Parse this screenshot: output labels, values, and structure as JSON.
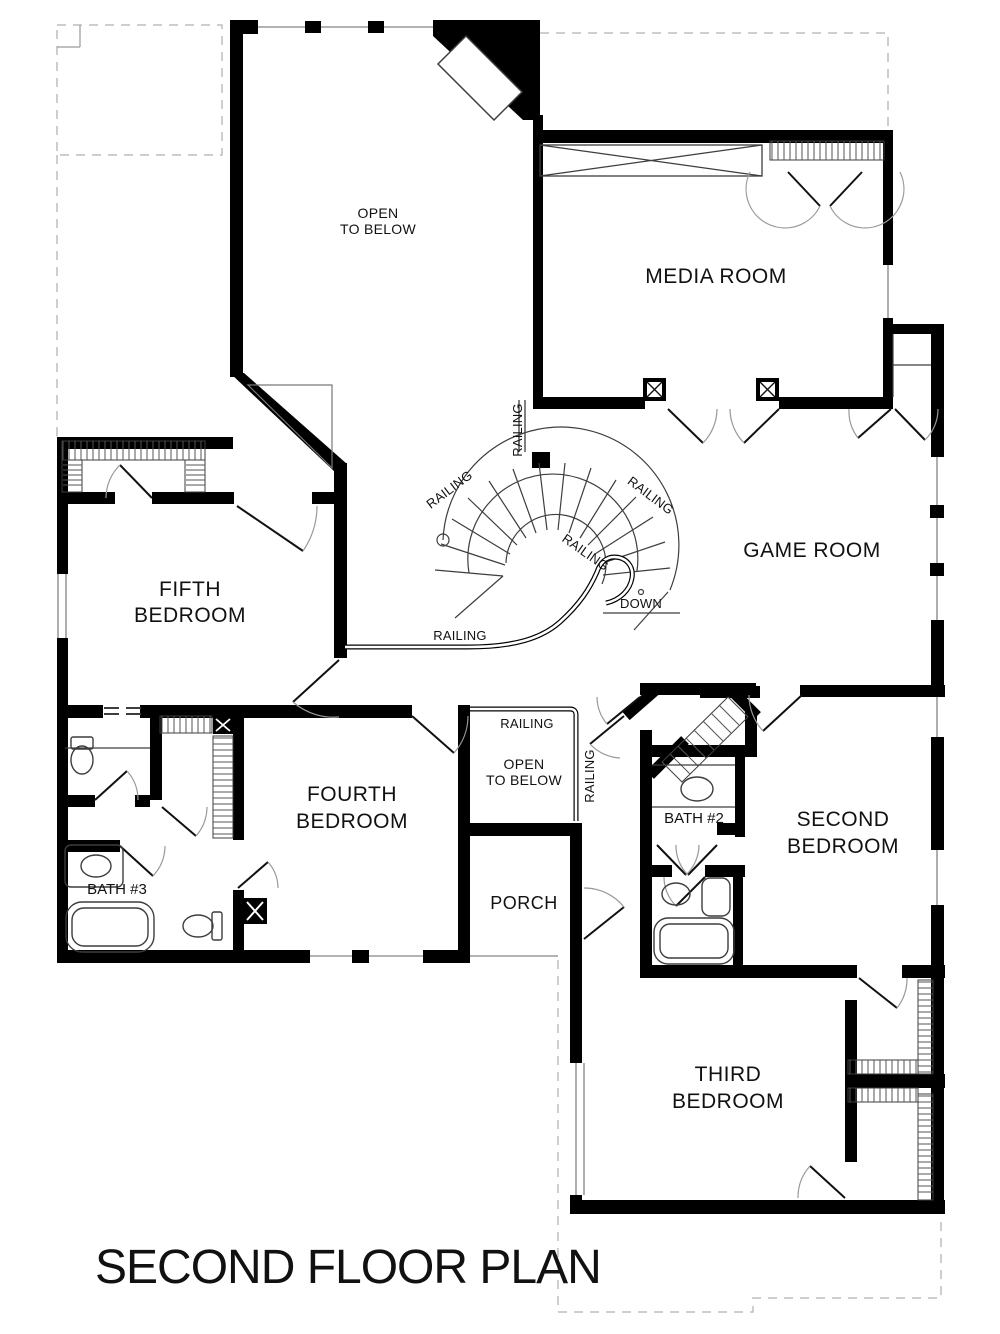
{
  "title": "SECOND FLOOR PLAN",
  "labels": {
    "open_to_below_line1": "OPEN",
    "open_to_below_line2": "TO BELOW",
    "media_room": "MEDIA ROOM",
    "game_room": "GAME ROOM",
    "fifth_line1": "FIFTH",
    "fifth_line2": "BEDROOM",
    "fourth_line1": "FOURTH",
    "fourth_line2": "BEDROOM",
    "second_line1": "SECOND",
    "second_line2": "BEDROOM",
    "third_line1": "THIRD",
    "third_line2": "BEDROOM",
    "open_below_small_line1": "OPEN",
    "open_below_small_line2": "TO BELOW",
    "porch": "PORCH",
    "bath2": "BATH #2",
    "bath3": "BATH #3",
    "railing": "RAILING",
    "down": "DOWN"
  },
  "colors": {
    "wall": "#000000",
    "thin_line": "#3d3d3d",
    "window_line": "#9a9a9a",
    "dash_line": "#bdbdbd",
    "text": "#111111",
    "background": "#ffffff"
  }
}
